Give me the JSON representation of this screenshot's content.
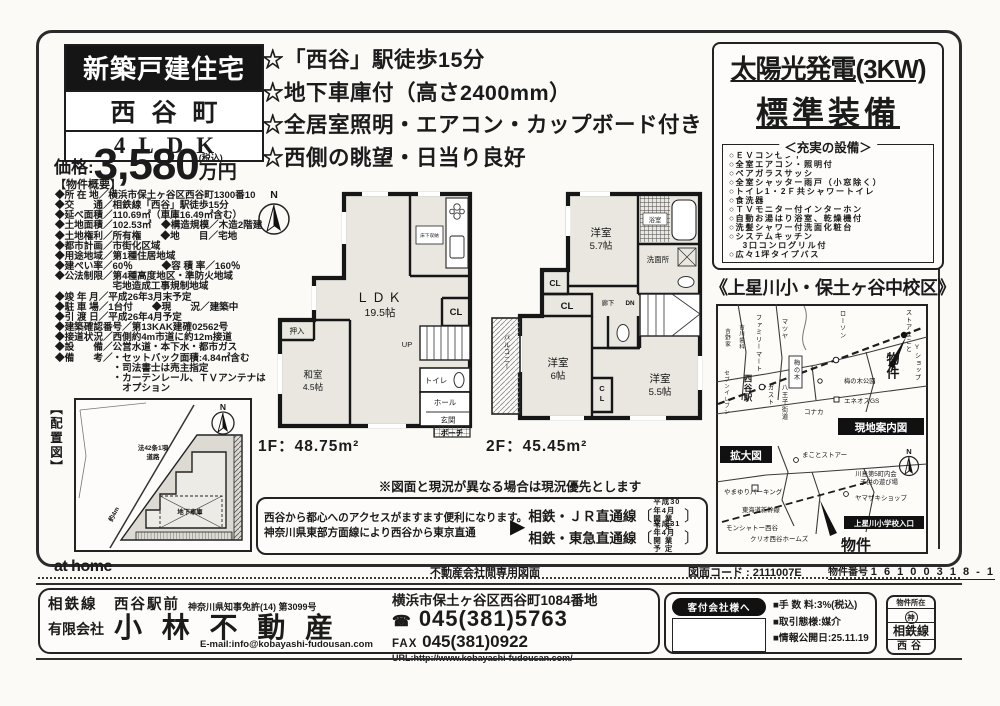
{
  "header": {
    "badge": "新築戸建住宅",
    "town": "西谷町",
    "layout": "4LDK",
    "price_label": "価格:",
    "price_value": "3,580",
    "price_tax": "(税込)",
    "price_unit": "万円"
  },
  "highlights": [
    "☆「西谷」駅徒歩15分",
    "☆地下車庫付（高さ2400mm）",
    "☆全居室照明・エアコン・カップボード付き",
    "☆西側の眺望・日当り良好"
  ],
  "outline": {
    "heading": "【物件概要】",
    "lines": [
      "◆所 在 地／横浜市保土ヶ谷区西谷町1300番10",
      "◆交　　通／相鉄線「西谷」駅徒歩15分",
      "◆延べ面積／110.69㎡（車庫16.49㎡含む）",
      "◆土地面積／102.53㎡　◆構造規模／木造2階建",
      "◆土地権利／所有権　　◆地　　目／宅地",
      "◆都市計画／市街化区域",
      "◆用途地域／第1種住居地域",
      "◆建ぺい率／60％　　　◆容 積 率／160％",
      "◆公法制限／第4種高度地区・準防火地域",
      "　　　　　　宅地造成工事規制地域",
      "◆竣 年 月／平成26年3月末予定",
      "◆駐 車 場／1台付　　◆現　　況／建築中",
      "◆引 渡 日／平成26年4月予定",
      "◆建築確認番号／第13KAK建確02562号",
      "◆接道状況／西側約4m市道に約12m接道",
      "◆設　　備／公営水道・本下水・都市ガス",
      "◆備　　考／・セットバック面積:4.84㎡含む",
      "　　　　　　・司法書士は売主指定",
      "　　　　　　・カーテンレール、ＴＶアンテナは",
      "　　　　　　　オプション"
    ]
  },
  "site_plan": {
    "label": "【配置図】",
    "road1": "法42条1項",
    "road2": "道路",
    "width": "約4m",
    "garage": "地下車庫",
    "north": "N"
  },
  "floor1": {
    "north": "N",
    "ldk": "ＬＤＫ",
    "ldk_size": "19.5帖",
    "yukashita": "床下収納",
    "cl": "CL",
    "up": "UP",
    "toilet": "トイレ",
    "hall": "ホール",
    "genkan": "玄関",
    "porch": "ポーチ",
    "oshiire": "押入",
    "washitsu": "和室",
    "washitsu_size": "4.5帖",
    "area": "1F：48.75m²"
  },
  "floor2": {
    "room1": "洋室",
    "room1_size": "5.7帖",
    "bath": "浴室",
    "senmen": "洗面所",
    "cl1": "CL",
    "cl2": "CL",
    "cl3": "CL",
    "rouka": "廊下",
    "dn": "DN",
    "room2": "洋室",
    "room2_size": "6帖",
    "room3": "洋室",
    "room3_size": "5.5帖",
    "balcony": "バルコニー",
    "area": "2F：45.45m²"
  },
  "note": "※図面と現況が異なる場合は現況優先とします",
  "access": {
    "line1": "西谷から都心へのアクセスがますます便利になります。",
    "line2": "神奈川県東部方面線により西谷から東京直通",
    "arrow": "▶",
    "route1": "相鉄・ＪＲ直通線",
    "route1_note1": "平成30年4月",
    "route1_note2": "開 業 予 定",
    "route2": "相鉄・東急直通線",
    "route2_note1": "平成31年4月",
    "route2_note2": "開 業 予 定",
    "bracket_open": "〔",
    "bracket_close": "〕"
  },
  "solar": {
    "line1": "太陽光発電(3KW)",
    "line2": "標準装備"
  },
  "equipment": {
    "heading": "＜充実の設備＞",
    "items": [
      "○ＥＶコンセント",
      "○全室エアコン・照明付",
      "○ペアガラスサッシ",
      "○全室シャッター雨戸（小窓除く）",
      "○トイレ1・2Ｆ共シャワートイレ",
      "○食洗器",
      "○ＴＶモニター付インターホン",
      "○自動お湯はり浴室、乾燥機付",
      "○洗髪シャワー付洗面化粧台",
      "○システムキッチン",
      "　 3口コンログリル付",
      "○広々1坪タイプバス"
    ]
  },
  "school": "《上星川小・保土ヶ谷中校区》",
  "map": {
    "guide": "現地案内図",
    "enlarge": "拡大図",
    "bukken": "物件",
    "north": "N",
    "top_labels": [
      "ストアまこと",
      "ローソン",
      "マツヤ",
      "ファミリーマート",
      "吉川歯科",
      "吉野家",
      "梅の木",
      "梅の木公園",
      "エネオスGS",
      "西谷駅",
      "セブンイレブン",
      "ガスト",
      "八王子街道",
      "コナカ",
      "Yショップ"
    ],
    "bottom_labels": [
      "まことストアー",
      "川島第5町内会",
      "子供の遊び場",
      "ヤマザキショップ",
      "やまゆりパーキング",
      "東海道新幹線",
      "モンシャトー西谷",
      "クリオ西谷ホームズ",
      "上星川小学校入口"
    ]
  },
  "footer": {
    "athome": "at home",
    "chuo": "不動産会社間専用図面",
    "zcode": "図面コード : 2111007E",
    "bnum_label": "物件番号",
    "bnum": "1 6 1 0 0 3 1 8 - 1",
    "line_station": "相鉄線　西谷駅前",
    "license": "神奈川県知事免許(14) 第3099号",
    "company_prefix": "有限会社",
    "company": "小 林 不 動 産",
    "email": "E-mail:info@kobayashi-fudousan.com",
    "address": "横浜市保土ヶ谷区西谷町1084番地",
    "tel_icon": "☎",
    "tel": "045(381)5763",
    "fax_label": "FAX",
    "fax": "045(381)0922",
    "url": "URL:http://www.kobayashi-fudousan.com/",
    "kyakutsuke": "客付会社様へ",
    "fee": "■手 数 料:3%(税込)",
    "torihiki": "■取引態様:媒介",
    "kokai": "■情報公開日:25.11.19",
    "stamp_title": "物件所在",
    "stamp_pref": "神",
    "stamp_line": "相鉄線",
    "stamp_station": "西谷"
  }
}
